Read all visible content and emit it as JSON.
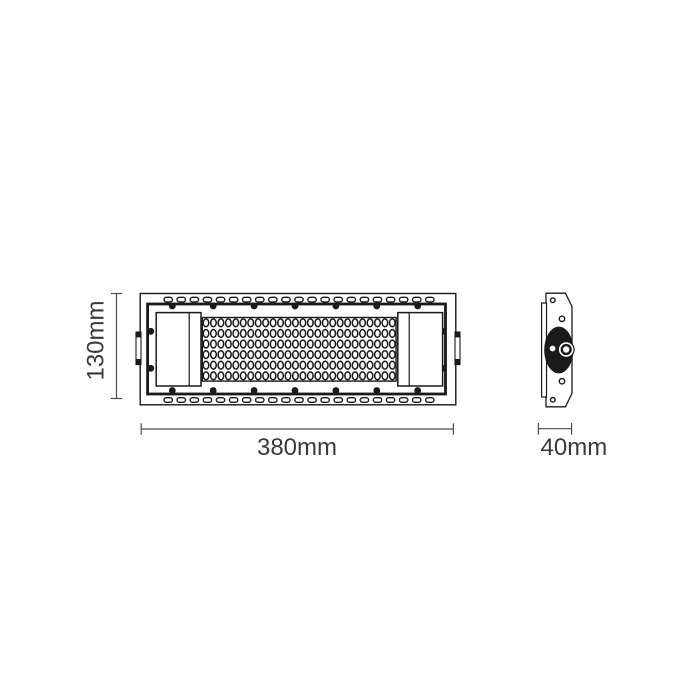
{
  "drawing": {
    "type": "technical-drawing",
    "subject": "linear LED flood light module, orthographic front and side views",
    "background": "#ffffff",
    "line_color": "#1a1a1a",
    "dim_line_color": "#4d4d4d",
    "dim_text_color": "#3a3a3a",
    "dimensions": {
      "height_label": "130mm",
      "width_label": "380mm",
      "depth_label": "40mm"
    },
    "front_view": {
      "vent_slot_rows": 2,
      "vent_slots_per_row": 21,
      "led_rows": 6,
      "led_columns": 26,
      "led_total": 156,
      "screws_top": 7,
      "screws_bottom": 7,
      "screws_left": 2,
      "screws_right": 2,
      "end_caps": 2,
      "mounting_tabs": 2
    },
    "side_view": {
      "screw_holes": 4,
      "has_pivot_hub": true,
      "has_center_bolt": true
    }
  }
}
